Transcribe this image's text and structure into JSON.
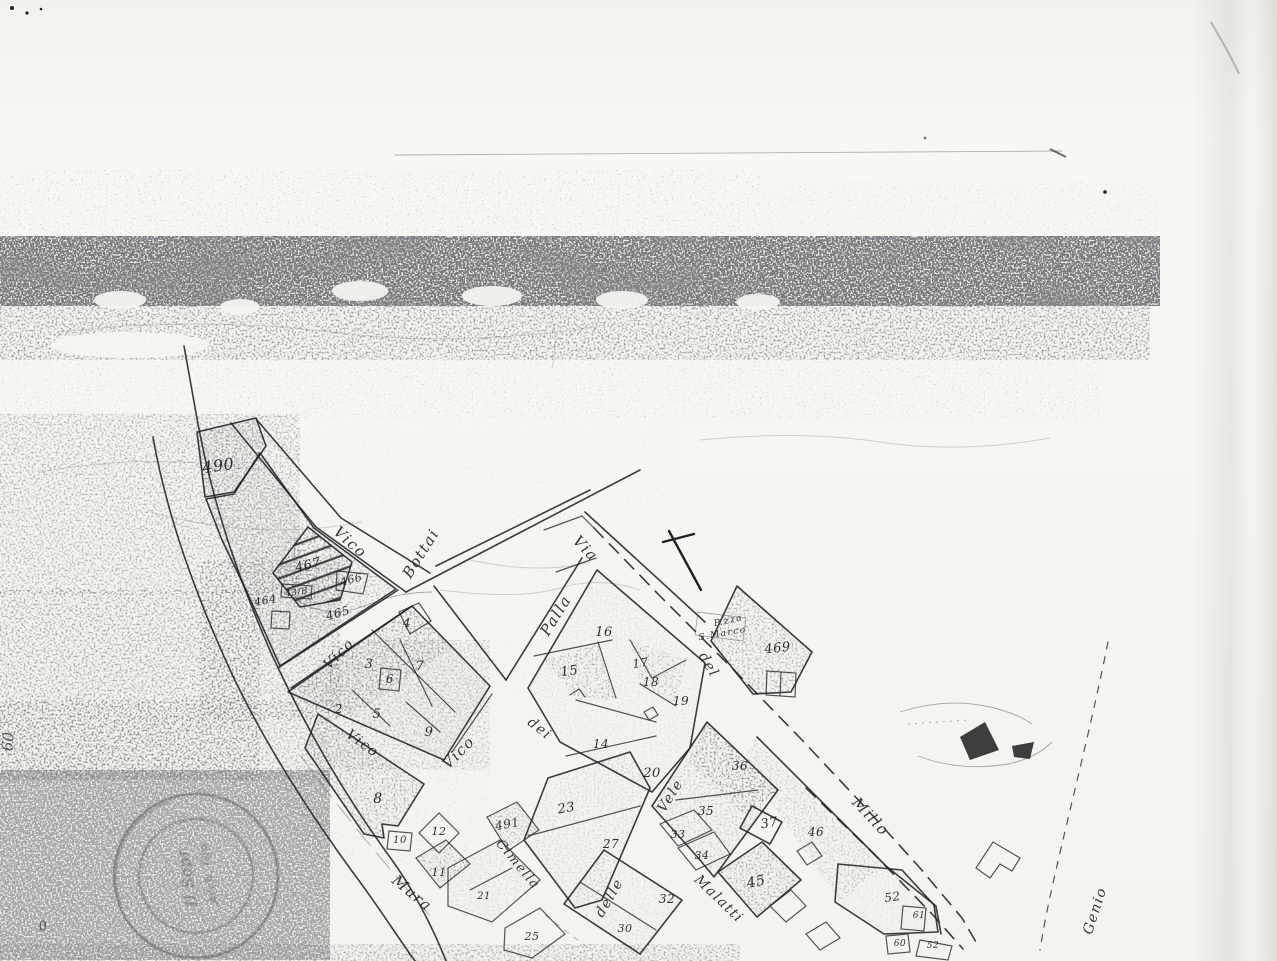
{
  "map": {
    "colors": {
      "ink": "#222226",
      "paper": "#f5f5f1",
      "noise_gray": "#2e2e2e"
    },
    "street_labels": [
      {
        "text": "Vico",
        "x": 347,
        "y": 546,
        "rot": 42,
        "size": 15
      },
      {
        "text": "Bottai",
        "x": 425,
        "y": 556,
        "rot": -58,
        "size": 15
      },
      {
        "text": "Via",
        "x": 582,
        "y": 552,
        "rot": 46,
        "size": 15
      },
      {
        "text": "Palla",
        "x": 560,
        "y": 618,
        "rot": -58,
        "size": 15
      },
      {
        "text": "P.zza",
        "x": 729,
        "y": 623,
        "rot": -12,
        "size": 9
      },
      {
        "text": "S.Marco",
        "x": 723,
        "y": 636,
        "rot": -10,
        "size": 9
      },
      {
        "text": "del",
        "x": 705,
        "y": 667,
        "rot": 60,
        "size": 14
      },
      {
        "text": "Vico",
        "x": 342,
        "y": 657,
        "rot": -45,
        "size": 14
      },
      {
        "text": "Vico",
        "x": 360,
        "y": 747,
        "rot": 36,
        "size": 14
      },
      {
        "text": "Vico",
        "x": 462,
        "y": 756,
        "rot": -45,
        "size": 15
      },
      {
        "text": "dei",
        "x": 537,
        "y": 732,
        "rot": 38,
        "size": 14
      },
      {
        "text": "Vele",
        "x": 674,
        "y": 798,
        "rot": -58,
        "size": 14
      },
      {
        "text": "delle",
        "x": 613,
        "y": 900,
        "rot": -60,
        "size": 14
      },
      {
        "text": "Cimella",
        "x": 515,
        "y": 867,
        "rot": 50,
        "size": 13
      },
      {
        "text": "Mura",
        "x": 409,
        "y": 897,
        "rot": 40,
        "size": 15
      },
      {
        "text": "Malatti",
        "x": 716,
        "y": 902,
        "rot": 44,
        "size": 14
      },
      {
        "text": "Millo",
        "x": 867,
        "y": 820,
        "rot": 47,
        "size": 15
      },
      {
        "text": "Genio",
        "x": 1099,
        "y": 912,
        "rot": -72,
        "size": 14
      }
    ],
    "parcel_labels": [
      {
        "text": "490",
        "x": 219,
        "y": 471,
        "rot": -8,
        "size": 16
      },
      {
        "text": "467",
        "x": 309,
        "y": 569,
        "rot": -14,
        "size": 13
      },
      {
        "text": "466",
        "x": 352,
        "y": 583,
        "rot": -14,
        "size": 11
      },
      {
        "text": "43/B",
        "x": 297,
        "y": 595,
        "rot": -8,
        "size": 9
      },
      {
        "text": "464",
        "x": 266,
        "y": 604,
        "rot": -10,
        "size": 11
      },
      {
        "text": "465",
        "x": 339,
        "y": 617,
        "rot": -16,
        "size": 12
      },
      {
        "text": "4",
        "x": 407,
        "y": 627,
        "rot": 0,
        "size": 12
      },
      {
        "text": "3",
        "x": 369,
        "y": 668,
        "rot": 0,
        "size": 13
      },
      {
        "text": "7",
        "x": 420,
        "y": 670,
        "rot": 0,
        "size": 13
      },
      {
        "text": "6",
        "x": 390,
        "y": 683,
        "rot": 0,
        "size": 12
      },
      {
        "text": "2",
        "x": 339,
        "y": 713,
        "rot": 0,
        "size": 12
      },
      {
        "text": "5",
        "x": 377,
        "y": 718,
        "rot": 0,
        "size": 13
      },
      {
        "text": "9",
        "x": 429,
        "y": 736,
        "rot": 0,
        "size": 13
      },
      {
        "text": "16",
        "x": 604,
        "y": 636,
        "rot": 0,
        "size": 13
      },
      {
        "text": "15",
        "x": 570,
        "y": 675,
        "rot": -8,
        "size": 13
      },
      {
        "text": "17",
        "x": 641,
        "y": 667,
        "rot": -8,
        "size": 12
      },
      {
        "text": "18",
        "x": 651,
        "y": 686,
        "rot": 0,
        "size": 12
      },
      {
        "text": "19",
        "x": 681,
        "y": 705,
        "rot": 0,
        "size": 12
      },
      {
        "text": "14",
        "x": 601,
        "y": 748,
        "rot": 0,
        "size": 12
      },
      {
        "text": "20",
        "x": 652,
        "y": 777,
        "rot": 0,
        "size": 13
      },
      {
        "text": "469",
        "x": 778,
        "y": 652,
        "rot": -6,
        "size": 13
      },
      {
        "text": "23",
        "x": 567,
        "y": 812,
        "rot": -10,
        "size": 13
      },
      {
        "text": "27",
        "x": 611,
        "y": 848,
        "rot": 0,
        "size": 12
      },
      {
        "text": "36",
        "x": 740,
        "y": 770,
        "rot": 0,
        "size": 12
      },
      {
        "text": "35",
        "x": 706,
        "y": 815,
        "rot": 0,
        "size": 12
      },
      {
        "text": "33",
        "x": 678,
        "y": 838,
        "rot": 0,
        "size": 11
      },
      {
        "text": "34",
        "x": 702,
        "y": 859,
        "rot": 0,
        "size": 11
      },
      {
        "text": "37",
        "x": 770,
        "y": 827,
        "rot": -10,
        "size": 13
      },
      {
        "text": "46",
        "x": 816,
        "y": 836,
        "rot": 0,
        "size": 12
      },
      {
        "text": "45",
        "x": 757,
        "y": 886,
        "rot": -12,
        "size": 14
      },
      {
        "text": "32",
        "x": 667,
        "y": 903,
        "rot": 0,
        "size": 12
      },
      {
        "text": "30",
        "x": 625,
        "y": 932,
        "rot": 0,
        "size": 11
      },
      {
        "text": "25",
        "x": 532,
        "y": 940,
        "rot": 0,
        "size": 11
      },
      {
        "text": "21",
        "x": 484,
        "y": 899,
        "rot": 0,
        "size": 10
      },
      {
        "text": "8",
        "x": 378,
        "y": 803,
        "rot": 0,
        "size": 14
      },
      {
        "text": "10",
        "x": 400,
        "y": 843,
        "rot": 0,
        "size": 10
      },
      {
        "text": "12",
        "x": 439,
        "y": 835,
        "rot": 0,
        "size": 11
      },
      {
        "text": "491",
        "x": 508,
        "y": 828,
        "rot": -10,
        "size": 12
      },
      {
        "text": "11",
        "x": 439,
        "y": 876,
        "rot": 0,
        "size": 11
      },
      {
        "text": "52",
        "x": 893,
        "y": 901,
        "rot": -8,
        "size": 12
      },
      {
        "text": "61",
        "x": 919,
        "y": 918,
        "rot": 0,
        "size": 9
      },
      {
        "text": "60",
        "x": 900,
        "y": 946,
        "rot": 0,
        "size": 9
      },
      {
        "text": "52",
        "x": 933,
        "y": 948,
        "rot": 0,
        "size": 9
      }
    ],
    "edge_marks": [
      {
        "text": "60",
        "x": 13,
        "y": 742,
        "rot": -85,
        "size": 15
      },
      {
        "text": "0",
        "x": 44,
        "y": 930,
        "rot": -15,
        "size": 13
      }
    ],
    "stamp": {
      "line1": "Il Sopr",
      "line2": "Arch. Gio"
    }
  }
}
